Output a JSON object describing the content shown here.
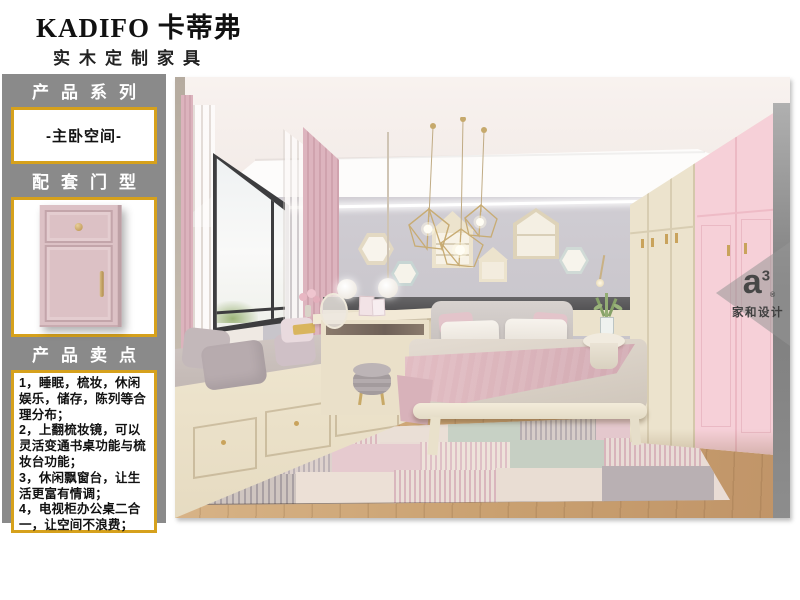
{
  "header": {
    "brand": "KADIFO 卡蒂弗",
    "tagline": "实木定制家具"
  },
  "sidebar": {
    "series": {
      "heading": "产品系列",
      "value": "-主卧空间-"
    },
    "door": {
      "heading": "配套门型"
    },
    "selling": {
      "heading": "产品卖点",
      "points": [
        "1，睡眠，梳妆，休闲娱乐，储存，陈列等合理分布；",
        "2，上翻梳妆镜，可以灵活变通书桌功能与梳妆台功能；",
        "3，休闲飘窗台，让生活更富有情调；",
        "4，电视柜办公桌二合一，让空间不浪费；"
      ]
    }
  },
  "photo": {
    "watermark": {
      "logo": "a",
      "logo_sup": "3",
      "reg": "®",
      "brand": "家和设计"
    }
  },
  "colors": {
    "panel_gray": "#8a8a8a",
    "accent_gold": "#d6a11c",
    "door_pink": "#dcc1c5",
    "wall_gray": "#cac7cd",
    "wardrobe_cream": "#ece3cd",
    "wardrobe_pink": "#f6d0d8"
  }
}
